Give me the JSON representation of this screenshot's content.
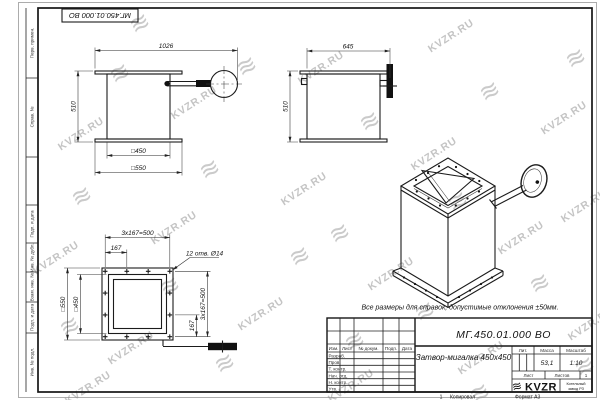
{
  "sheet": {
    "corner_stamp": "МГ.450.01.000 ВО",
    "note": "Все размеры для справок, допустимые отклонения ±50мм.",
    "watermark_text": "KVZR.RU",
    "footer": {
      "num": "1",
      "copy": "Копировал",
      "format": "Формат А3"
    }
  },
  "left_margin": {
    "items": [
      "Перв. примен.",
      "Справ. №",
      "Подп. и дата",
      "Инв. № дубл.",
      "Взам. инв. №",
      "Подп. и дата",
      "Инв. № подл."
    ]
  },
  "views": {
    "front": {
      "dim_width": "1026",
      "dim_height": "510",
      "dim_inner": "□450",
      "dim_outer": "□550"
    },
    "side": {
      "dim_width": "645",
      "dim_height": "510"
    },
    "plan": {
      "dim_pitch_top": "3x167=500",
      "dim_offset_top": "167",
      "holes_note": "12 отв. Ø14",
      "dim_outer": "□550",
      "dim_inner": "□450",
      "dim_pitch_right": "3x167=500",
      "dim_offset_right": "167"
    }
  },
  "title_block": {
    "designation": "МГ.450.01.000 ВО",
    "name": "Затвор-мигалка 450x450",
    "cols": {
      "izm": "Изм.",
      "list": "Лист",
      "doc": "№ докум.",
      "sign": "Подп.",
      "date": "Дата"
    },
    "rows": [
      "Разраб.",
      "Пров.",
      "Т. контр.",
      "Нач. отд.",
      "Н. контр.",
      "Утв."
    ],
    "lit": "Лит.",
    "mass": "Масса",
    "scale": "Масштаб",
    "mass_value": "53,1",
    "scale_value": "1:10",
    "sheet": "Лист",
    "sheets": "Листов",
    "sheets_value": "1",
    "logo": "KVZR",
    "company_line1": "Котельный",
    "company_line2": "завод РЗ"
  }
}
